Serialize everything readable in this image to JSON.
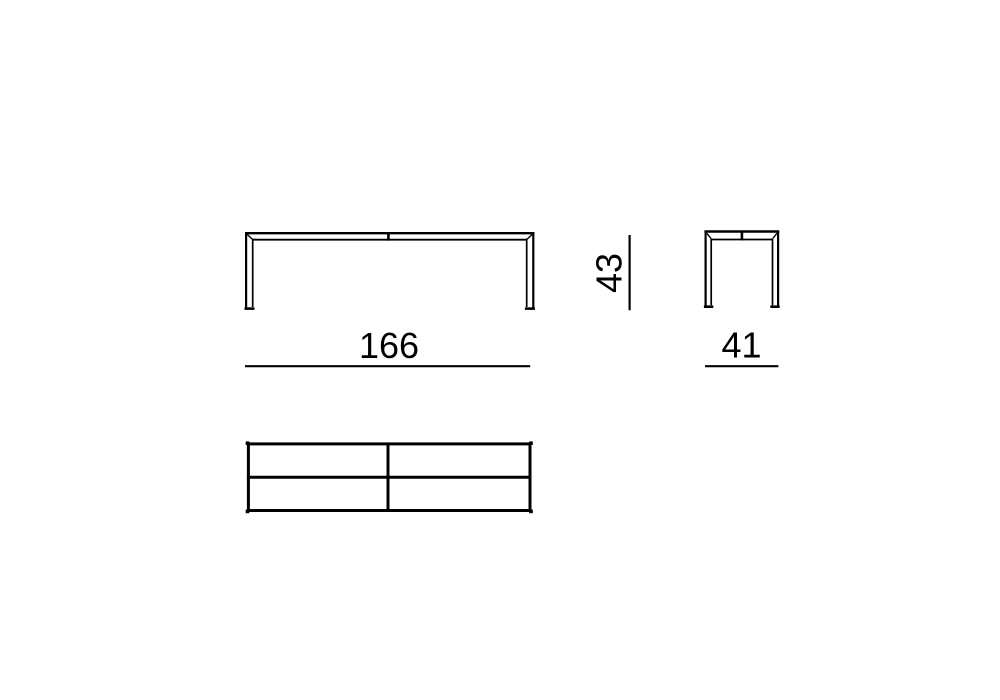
{
  "colors": {
    "line": "#000000",
    "text": "#000000",
    "background": "#ffffff"
  },
  "dimensions": {
    "width": {
      "label": "166"
    },
    "depth": {
      "label": "41"
    },
    "height": {
      "label": "43"
    }
  }
}
